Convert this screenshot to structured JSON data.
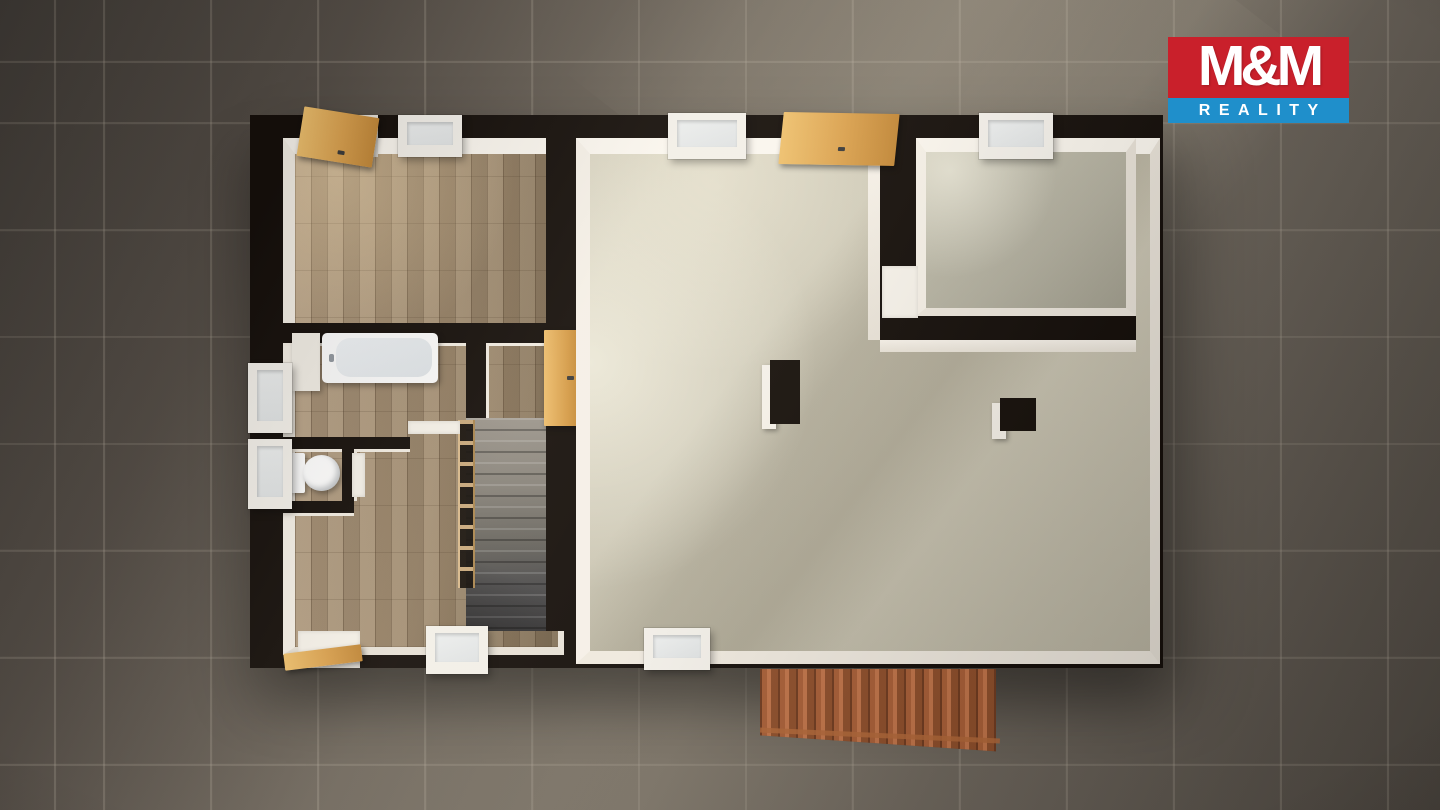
{
  "scene": {
    "type": "3d-floor-plan-top-down-render",
    "canvas": {
      "width": 1440,
      "height": 810
    }
  },
  "logo": {
    "title": "M&M",
    "subtitle": "REALITY",
    "title_bg": "#c9202b",
    "subtitle_bg": "#1f8fcb",
    "text_color": "#ffffff"
  },
  "palette": {
    "ground": "#6b645c",
    "grout": "#a59c8e",
    "wall": "#150f0b",
    "wall-face-lit": "#f9f5ee",
    "wall-face-shade": "#e7e1d7",
    "parquet": "#a18c71",
    "screed": "#c8c3b1",
    "screed-dark": "#b2af9f",
    "wood-door": "#d9a04e",
    "stair-carpet": "#87827a",
    "ext-stair": "#a85f38",
    "logo-red": "#c9202b",
    "logo-blue": "#1f8fcb"
  },
  "floorplan": {
    "building": {
      "walls": "dark",
      "wall_faces": "white"
    },
    "rooms": [
      {
        "id": "top-left-room",
        "floor": "parquet"
      },
      {
        "id": "bathroom",
        "floor": "parquet",
        "fixtures": [
          "bathtub"
        ]
      },
      {
        "id": "wc",
        "floor": "parquet",
        "fixtures": [
          "toilet"
        ]
      },
      {
        "id": "hallway",
        "floor": "parquet",
        "fixtures": [
          "interior-staircase",
          "railing"
        ]
      },
      {
        "id": "living-room",
        "floor": "screed",
        "fixtures": [
          "column",
          "column"
        ]
      },
      {
        "id": "top-right-room",
        "floor": "screed"
      }
    ],
    "openings": {
      "top_wall": [
        "wood-door-open",
        "window",
        "window",
        "wood-double-door-open",
        "window"
      ],
      "left_wall": [
        "window-bathroom",
        "window-wc"
      ],
      "bottom_wall": [
        "entrance-door-open",
        "window",
        "window"
      ],
      "interior": [
        "wood-door-hall-living",
        "white-door-bathroom",
        "white-door-wc",
        "door-opening-top-right-room"
      ]
    },
    "exterior": [
      "tiled-ground",
      "exterior-staircase"
    ]
  }
}
